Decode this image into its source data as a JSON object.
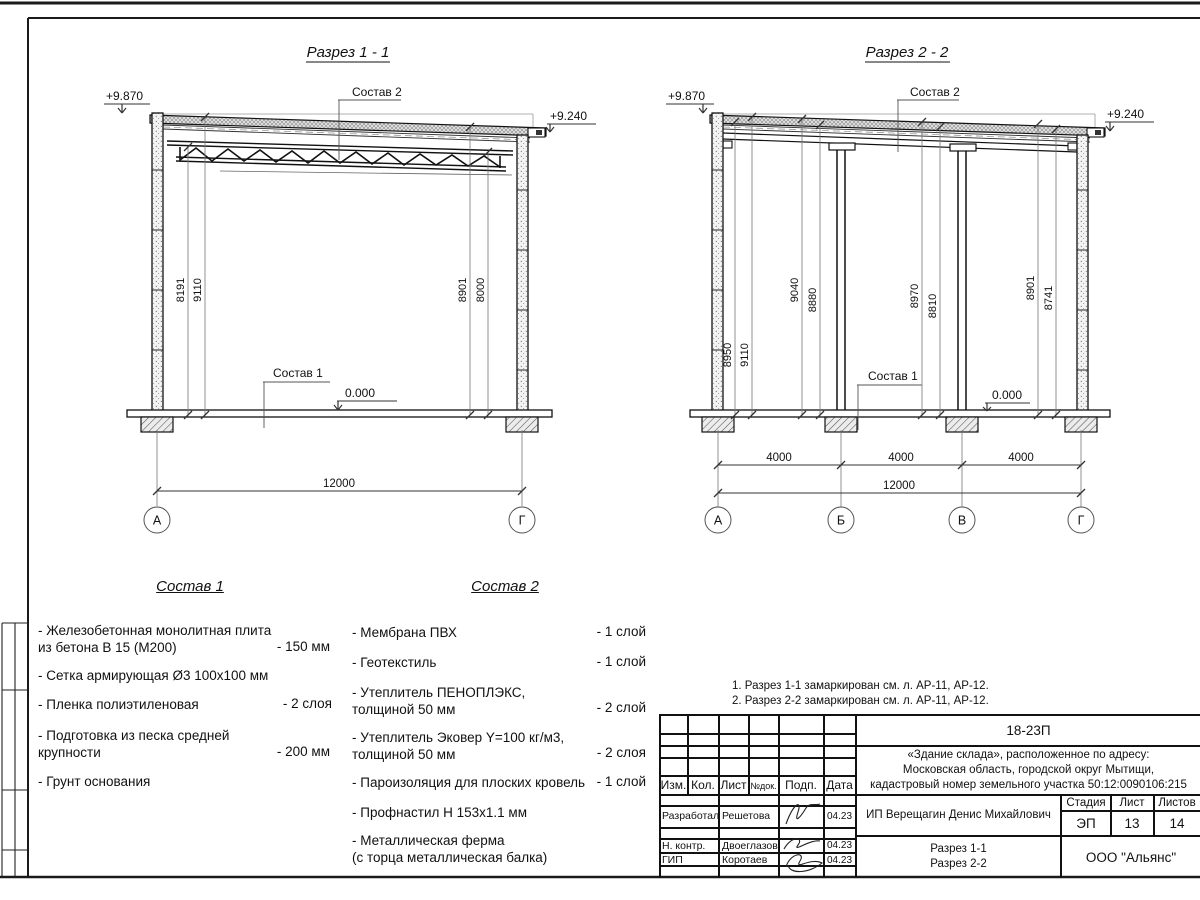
{
  "s1": {
    "title": "Разрез 1 - 1",
    "elev_top_left": "+9.870",
    "elev_top_right": "+9.240",
    "callout_roof": "Состав 2",
    "callout_floor": "Состав 1",
    "elev_floor": "0.000",
    "dim_8191": "8191",
    "dim_9110": "9110",
    "dim_8901": "8901",
    "dim_8000": "8000",
    "dim_total": "12000",
    "axis_a": "А",
    "axis_g": "Г"
  },
  "s2": {
    "title": "Разрез 2 - 2",
    "elev_top_left": "+9.870",
    "elev_top_right": "+9.240",
    "callout_roof": "Состав 2",
    "callout_floor": "Состав 1",
    "elev_floor": "0.000",
    "dim_8950": "8950",
    "dim_9110": "9110",
    "dim_9040": "9040",
    "dim_8880": "8880",
    "dim_8970": "8970",
    "dim_8810": "8810",
    "dim_8901": "8901",
    "dim_8741": "8741",
    "span1": "4000",
    "span2": "4000",
    "span3": "4000",
    "dim_total": "12000",
    "axis_a": "А",
    "axis_b": "Б",
    "axis_v": "В",
    "axis_g": "Г"
  },
  "sostav1": {
    "title": "Состав 1",
    "items": [
      {
        "text": "- Железобетонная  монолитная плита\nиз бетона В 15 (М200)",
        "value": "- 150 мм"
      },
      {
        "text": "- Сетка армирующая Ø3 100х100 мм",
        "value": ""
      },
      {
        "text": "- Пленка полиэтиленовая",
        "value": "-  2 слоя"
      },
      {
        "text": "- Подготовка из песка средней\nкрупности",
        "value": "- 200 мм"
      },
      {
        "text": "- Грунт основания",
        "value": ""
      }
    ]
  },
  "sostav2": {
    "title": "Состав 2",
    "items": [
      {
        "text": "- Мембрана ПВХ",
        "value": "- 1 слой"
      },
      {
        "text": "- Геотекстиль",
        "value": "- 1 слой"
      },
      {
        "text": "- Утеплитель ПЕНОПЛЭКС,\nтолщиной 50 мм",
        "value": "- 2 слой"
      },
      {
        "text": "- Утеплитель Эковер Y=100 кг/м3,\nтолщиной 50 мм",
        "value": "- 2 слоя"
      },
      {
        "text": "- Пароизоляция для плоских кровель",
        "value": "- 1 слой"
      },
      {
        "text": "- Профнастил Н 153х1.1 мм",
        "value": ""
      },
      {
        "text": "- Металлическая ферма\n(с торца металлическая балка)",
        "value": ""
      }
    ]
  },
  "notes": {
    "n1": "1. Разрез 1-1 замаркирован см. л. АР-11, АР-12.",
    "n2": "2. Разрез 2-2 замаркирован см. л. АР-11, АР-12."
  },
  "titleblock": {
    "code": "18-23П",
    "object": "«Здание склада», расположенное по адресу:\nМосковская область, городской округ Мытищи,\nкадастровый номер земельного участка 50:12:0090106:215",
    "col_izm": "Изм.",
    "col_kol": "Кол.",
    "col_list": "Лист",
    "col_ndoc": "№док.",
    "col_podp": "Подп.",
    "col_data": "Дата",
    "role1": "Разработал",
    "name1": "Решетова",
    "date1": "04.23",
    "role2": "Н. контр.",
    "name2": "Двоеглазов",
    "date2": "04.23",
    "role3": "ГИП",
    "name3": "Коротаев",
    "date3": "04.23",
    "client": "ИП Верещагин Денис Михайлович",
    "stage_label": "Стадия",
    "stage_value": "ЭП",
    "sheet_label": "Лист",
    "sheet_value": "13",
    "sheets_label": "Листов",
    "sheets_value": "14",
    "doc_name": "Разрез 1-1\nРазрез 2-2",
    "company": "ООО \"Альянс\""
  }
}
